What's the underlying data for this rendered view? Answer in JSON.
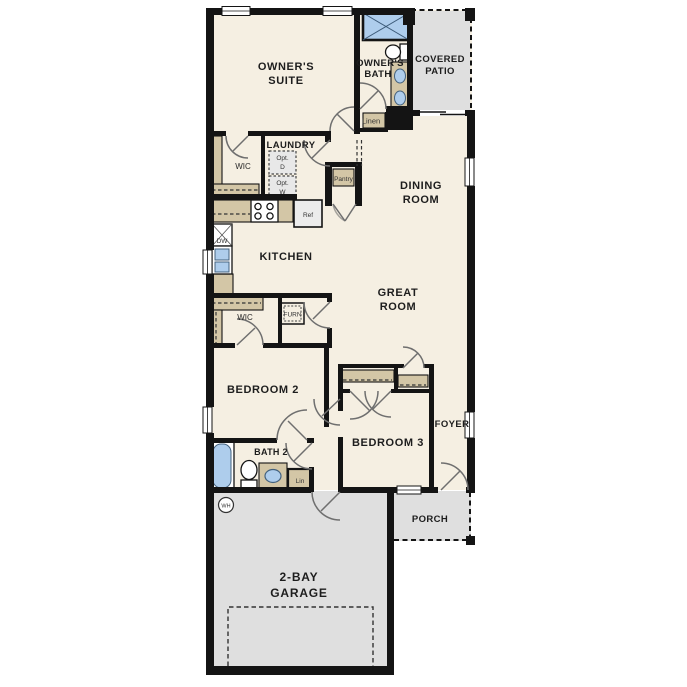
{
  "plan": {
    "colors": {
      "wall": "#141414",
      "floor": "#f5efe2",
      "concrete": "#dfdfdf",
      "casework_tan": "#d3c6a6",
      "fixture_blue": "#aecdec",
      "door_swing_gray": "#6f6f6f",
      "label_text": "#1d1d1d",
      "optional_item_fill": "#e8e8e8"
    },
    "rooms": {
      "owners_suite": {
        "line1": "OWNER'S",
        "line2": "SUITE"
      },
      "owners_bath": {
        "line1": "OWNER'S",
        "line2": "BATH"
      },
      "covered_patio": {
        "line1": "COVERED",
        "line2": "PATIO"
      },
      "wic_owners": {
        "label": "WIC"
      },
      "laundry": {
        "label": "LAUNDRY"
      },
      "dining_room": {
        "line1": "DINING",
        "line2": "ROOM"
      },
      "kitchen": {
        "label": "KITCHEN"
      },
      "great_room": {
        "line1": "GREAT",
        "line2": "ROOM"
      },
      "wic_hall": {
        "label": "WIC"
      },
      "bedroom2": {
        "label": "BEDROOM 2"
      },
      "bedroom3": {
        "label": "BEDROOM 3"
      },
      "bath2": {
        "label": "BATH 2"
      },
      "foyer": {
        "label": "FOYER"
      },
      "porch": {
        "label": "PORCH"
      },
      "garage": {
        "line1": "2-BAY",
        "line2": "GARAGE"
      }
    },
    "fixtures": {
      "linen": "Linen",
      "pantry": "Pantry",
      "ref": "Ref",
      "dw": "DW",
      "opt_dryer_line1": "Opt.",
      "opt_dryer_line2": "D",
      "opt_washer_line1": "Opt.",
      "opt_washer_line2": "W",
      "furnace": "FURN",
      "lin": "Lin",
      "water_heater": "WH"
    }
  }
}
